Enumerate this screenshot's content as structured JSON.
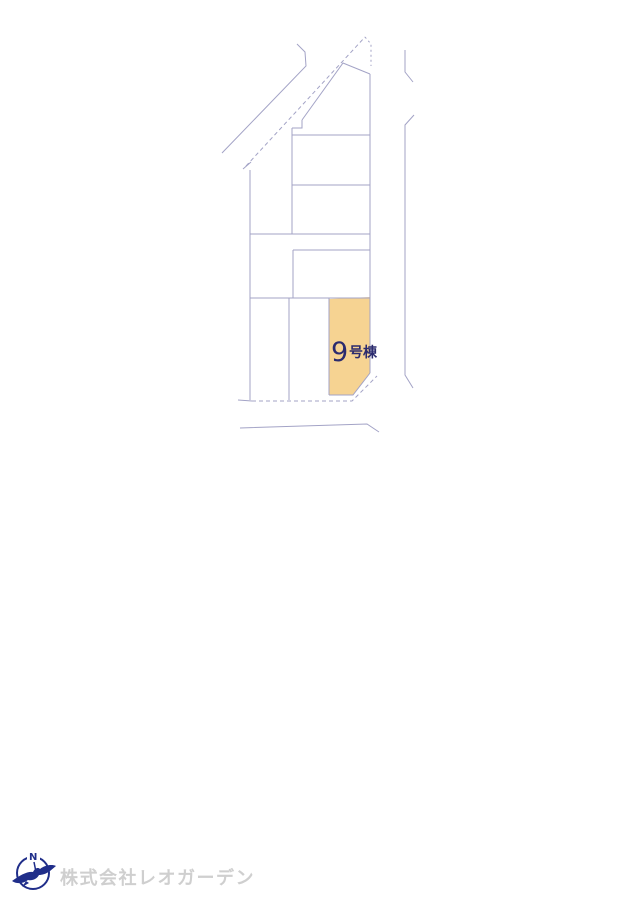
{
  "plan": {
    "highlighted_lot": {
      "number": "9",
      "suffix": "号棟",
      "label": "9号棟"
    },
    "colors": {
      "line": "#a3a3c6",
      "highlight_fill": "#f6d392",
      "label_text": "#2b2b6e"
    }
  },
  "footer": {
    "company": "株式会社レオガーデン",
    "logo_letter": "N",
    "colors": {
      "logo": "#202e8a",
      "company_text": "#cfcfcf"
    }
  }
}
